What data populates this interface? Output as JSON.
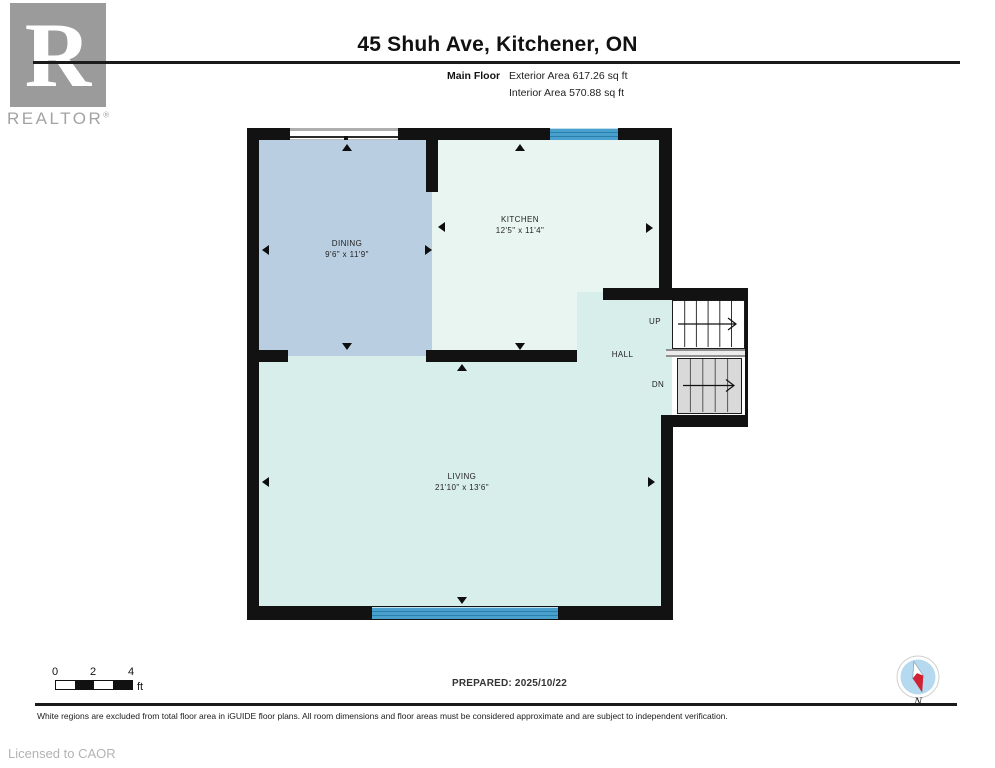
{
  "header": {
    "title": "45 Shuh Ave, Kitchener, ON",
    "floor_label": "Main Floor",
    "exterior_area": "Exterior Area 617.26 sq ft",
    "interior_area": "Interior Area 570.88 sq ft"
  },
  "logo": {
    "letter": "R",
    "wordmark": "REALTOR",
    "registered": "®"
  },
  "rooms": {
    "dining": {
      "name": "DINING",
      "dims": "9'6\" x 11'9\""
    },
    "kitchen": {
      "name": "KITCHEN",
      "dims": "12'5\" x 11'4\""
    },
    "hall": {
      "name": "HALL"
    },
    "living": {
      "name": "LIVING",
      "dims": "21'10\" x 13'6\""
    }
  },
  "stairs": {
    "up_label": "UP",
    "down_label": "DN"
  },
  "scale_bar": {
    "tick_0": "0",
    "tick_2": "2",
    "tick_4": "4",
    "unit": "ft"
  },
  "compass": {
    "north_label": "N"
  },
  "footer": {
    "prepared": "PREPARED: 2025/10/22",
    "disclaimer": "White regions are excluded from total floor area in iGUIDE floor plans. All room dimensions and floor areas must be considered approximate and are subject to independent verification.",
    "license": "Licensed to CAOR"
  },
  "colors": {
    "wall": "#121212",
    "dining_fill": "#b9cee1",
    "kitchen_fill": "#e8f5f1",
    "living_fill": "#d7eeea",
    "window_blue": "#4aa0cc",
    "window_stripe": "#2a7fae",
    "stair_gray": "#d9d9d9",
    "logo_gray": "#9b9b9b",
    "compass_red": "#cf2233",
    "compass_blue": "#b5d9ee"
  }
}
